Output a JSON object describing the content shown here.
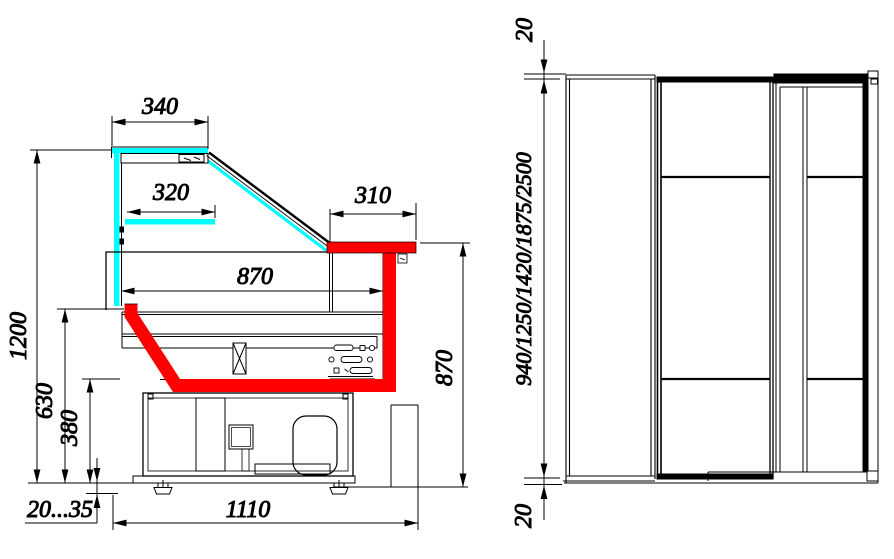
{
  "drawing": {
    "title": "refrigerated-display-case-dimension-drawing",
    "colors": {
      "glass": "#00FFFF",
      "accent": "#FF0000",
      "line": "#000000",
      "background": "#FFFFFF"
    },
    "section_view": {
      "canopy_width": "340",
      "shelf_width": "320",
      "counter_depth": "310",
      "display_width": "870",
      "overall_height": "1200",
      "counter_height": "630",
      "base_height": "380",
      "foot_adjustment": "20...35",
      "overall_depth": "1110",
      "counter_top_height": "870"
    },
    "front_view": {
      "top_offset": "20",
      "bottom_offset": "20",
      "height_options": "940/1250/1420/1875/2500"
    }
  }
}
